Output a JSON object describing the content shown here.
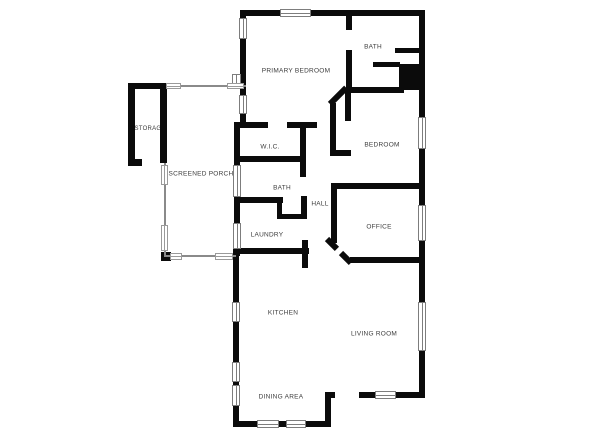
{
  "plan": {
    "type": "residential-floor-plan",
    "colors": {
      "wall": "#0b0b0b",
      "porch_line": "#8a8a8a",
      "window_line": "#7d7d7d",
      "label_text": "#3c3c3c",
      "background": "#ffffff"
    },
    "rooms": [
      {
        "id": "primary-bedroom",
        "label": "PRIMARY BEDROOM"
      },
      {
        "id": "bath-ensuite",
        "label": "BATH"
      },
      {
        "id": "bedroom",
        "label": "BEDROOM"
      },
      {
        "id": "wic",
        "label": "W.I.C."
      },
      {
        "id": "storage",
        "label": "STORAGE"
      },
      {
        "id": "screened-porch",
        "label": "SCREENED PORCH"
      },
      {
        "id": "bath-hall",
        "label": "BATH"
      },
      {
        "id": "hall",
        "label": "HALL"
      },
      {
        "id": "laundry",
        "label": "LAUNDRY"
      },
      {
        "id": "office",
        "label": "OFFICE"
      },
      {
        "id": "kitchen",
        "label": "KITCHEN"
      },
      {
        "id": "living-room",
        "label": "LIVING ROOM"
      },
      {
        "id": "dining-area",
        "label": "DINING AREA"
      }
    ]
  }
}
